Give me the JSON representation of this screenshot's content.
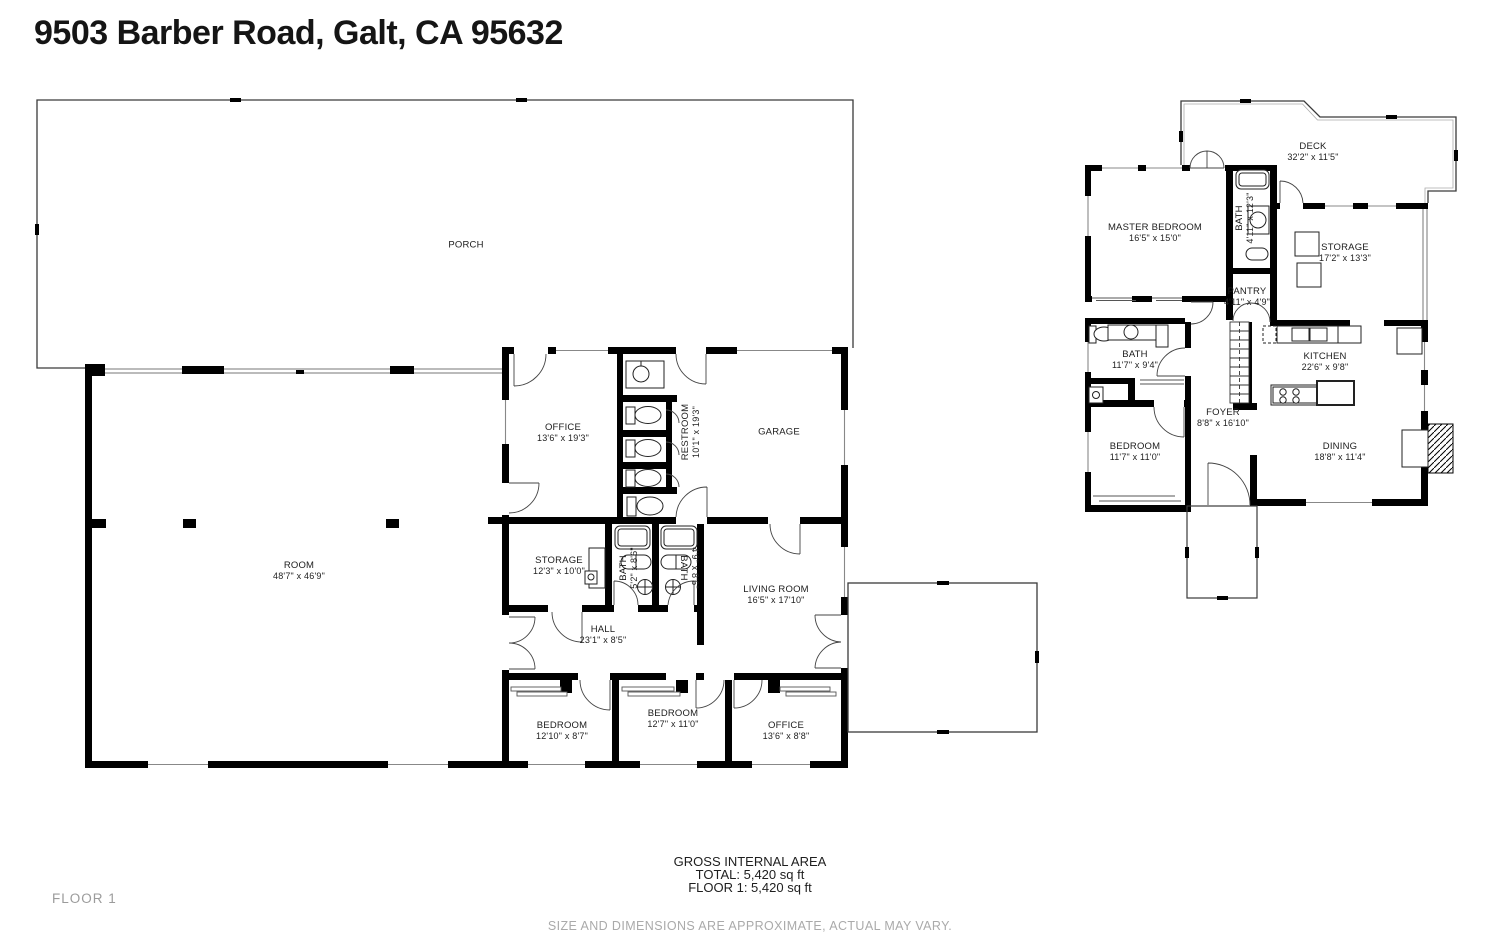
{
  "title": "9503 Barber Road, Galt, CA 95632",
  "floor1": {
    "rooms": [
      {
        "name": "PORCH",
        "dims": ""
      },
      {
        "name": "OFFICE",
        "dims": "13'6\" x 19'3\""
      },
      {
        "name": "RESTROOM",
        "dims": "10'1\" x 19'3\""
      },
      {
        "name": "GARAGE",
        "dims": ""
      },
      {
        "name": "ROOM",
        "dims": "48'7\" x 46'9\""
      },
      {
        "name": "STORAGE",
        "dims": "12'3\" x 10'0\""
      },
      {
        "name": "BATH",
        "dims": "5'2\" x 8'6\""
      },
      {
        "name": "BATH",
        "dims": "4'9\" x 8'6\""
      },
      {
        "name": "LIVING ROOM",
        "dims": "16'5\" x 17'10\""
      },
      {
        "name": "HALL",
        "dims": "23'1\" x 8'5\""
      },
      {
        "name": "BEDROOM",
        "dims": "12'10\" x 8'7\""
      },
      {
        "name": "BEDROOM",
        "dims": "12'7\" x 11'0\""
      },
      {
        "name": "OFFICE",
        "dims": "13'6\" x 8'8\""
      }
    ]
  },
  "floor2": {
    "rooms": [
      {
        "name": "DECK",
        "dims": "32'2\" x 11'5\""
      },
      {
        "name": "MASTER BEDROOM",
        "dims": "16'5\" x 15'0\""
      },
      {
        "name": "BATH",
        "dims": "4'11\" x 12'3\""
      },
      {
        "name": "STORAGE",
        "dims": "17'2\" x 13'3\""
      },
      {
        "name": "PANTRY",
        "dims": "4'11\" x 4'9\""
      },
      {
        "name": "BATH",
        "dims": "11'7\" x 9'4\""
      },
      {
        "name": "KITCHEN",
        "dims": "22'6\" x 9'8\""
      },
      {
        "name": "FOYER",
        "dims": "8'8\" x 16'10\""
      },
      {
        "name": "BEDROOM",
        "dims": "11'7\" x 11'0\""
      },
      {
        "name": "DINING",
        "dims": "18'8\" x 11'4\""
      }
    ]
  },
  "summary": {
    "heading": "GROSS INTERNAL AREA",
    "total": "TOTAL: 5,420 sq ft",
    "floor1_line": "FLOOR 1: 5,420 sq ft"
  },
  "footer": {
    "floor_label": "FLOOR 1",
    "disclaimer": "SIZE AND DIMENSIONS ARE APPROXIMATE, ACTUAL MAY VARY."
  }
}
